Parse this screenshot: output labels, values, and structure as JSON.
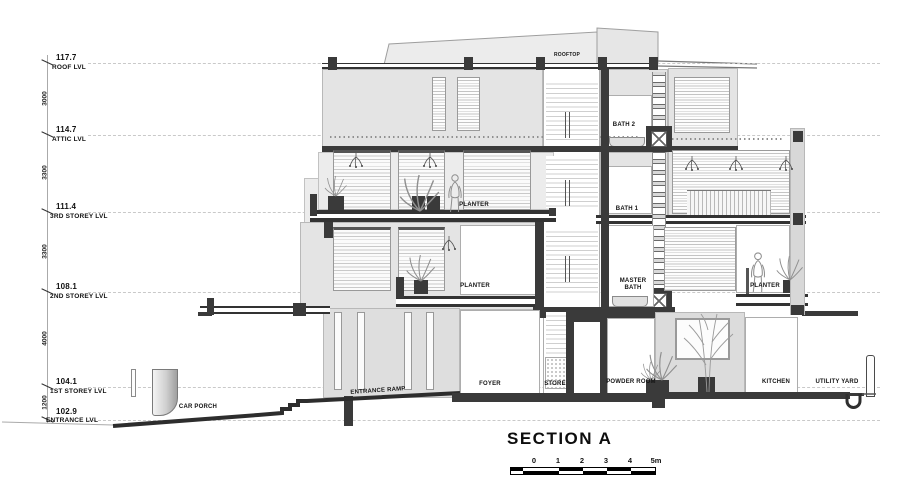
{
  "title": "SECTION A",
  "levels": [
    {
      "elevation": "117.7",
      "name": "ROOF LVL"
    },
    {
      "elevation": "114.7",
      "name": "ATTIC LVL"
    },
    {
      "elevation": "111.4",
      "name": "3RD STOREY LVL"
    },
    {
      "elevation": "108.1",
      "name": "2ND STOREY LVL"
    },
    {
      "elevation": "104.1",
      "name": "1ST STOREY LVL"
    },
    {
      "elevation": "102.9",
      "name": "ENTRANCE LVL"
    }
  ],
  "dimensions": [
    "3000",
    "3300",
    "3300",
    "4000",
    "1200"
  ],
  "rooms": {
    "rooftop": "ROOFTOP",
    "bath2": "BATH 2",
    "bath1": "BATH 1",
    "planter_a": "PLANTER",
    "planter_b": "PLANTER",
    "planter_c": "PLANTER",
    "master_bath": "MASTER BATH",
    "entrance_ramp": "ENTRANCE RAMP",
    "foyer": "FOYER",
    "store": "STORE",
    "powder_room": "POWDER ROOM",
    "kitchen": "KITCHEN",
    "utility_yard": "UTILITY YARD",
    "car_porch": "CAR PORCH"
  },
  "scale_bar": {
    "labels": [
      "0",
      "1",
      "2",
      "3",
      "4",
      "5m"
    ]
  },
  "colors": {
    "wall": "#e4e4e4",
    "structure": "#3a3a3a",
    "drawing_line": "#9a9a9a",
    "text": "#141414"
  }
}
